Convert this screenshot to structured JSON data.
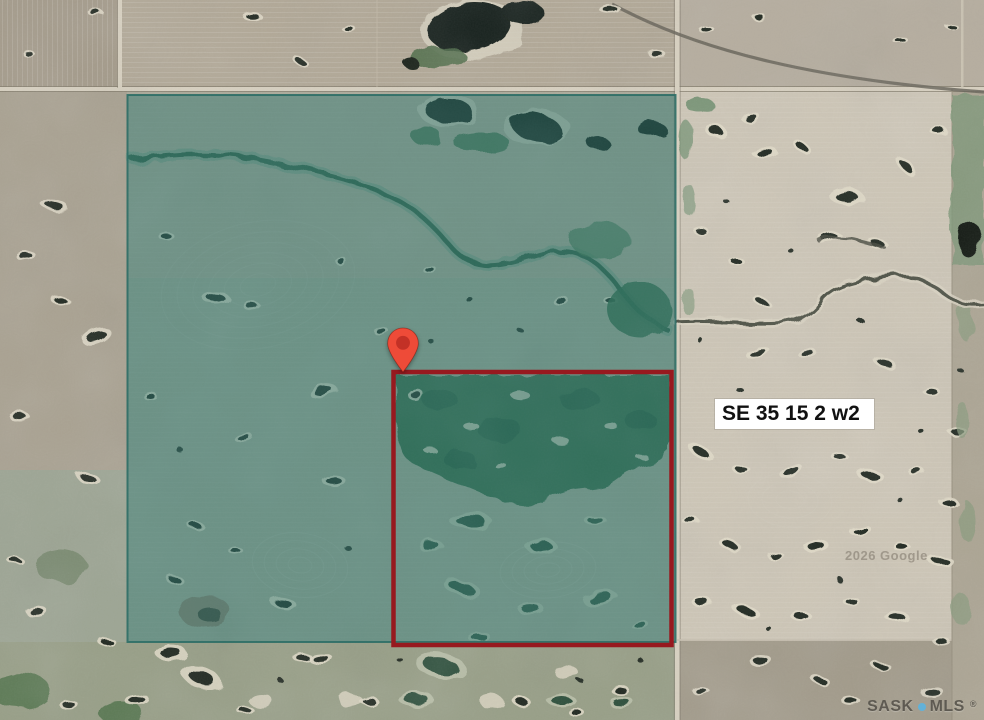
{
  "map": {
    "parcel_label": "SE 35 15 2 w2",
    "google_watermark": "2026 Google",
    "branding": {
      "name_left": "SASK",
      "name_right": "MLS",
      "registered": "®"
    },
    "colors": {
      "overlay_teal": "#2b766e",
      "overlay_border": "#2e6e66",
      "parcel_outline": "#97191f",
      "pin_body": "#ee4b38",
      "pin_core": "#c33126",
      "mls_dot": "#5fb3dc",
      "mls_text": "#5b574f"
    }
  }
}
